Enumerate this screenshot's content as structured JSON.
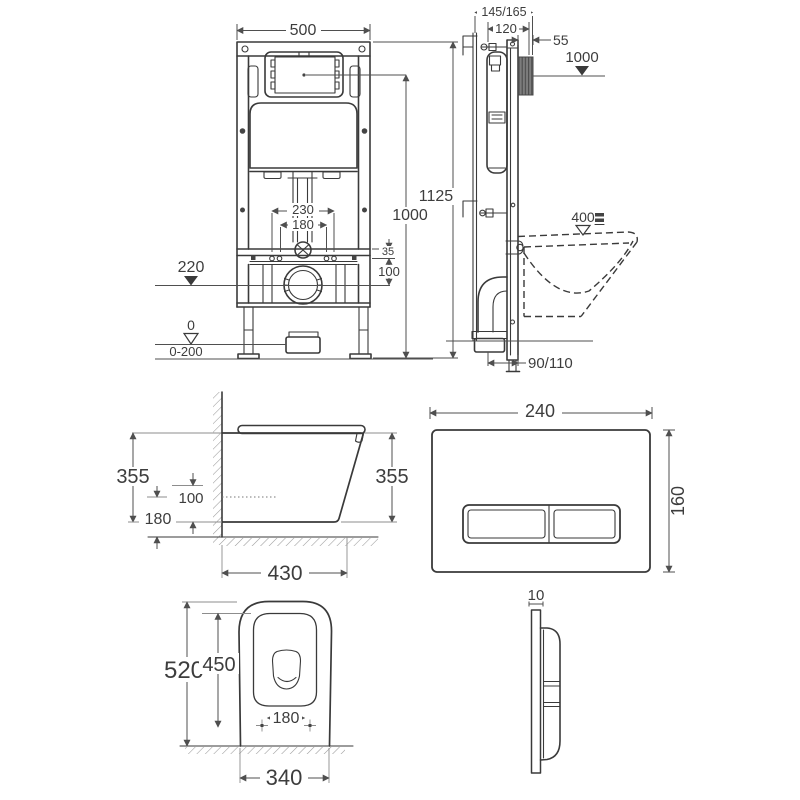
{
  "colors": {
    "line": "#3a3a3a",
    "dim": "#4f4f4f",
    "light": "#8d8d8d",
    "text": "#3d3d3d",
    "background": "#ffffff"
  },
  "views": {
    "frame_front": {
      "dims": {
        "width": "500",
        "total_height": "1125",
        "panel_center_height": "1000",
        "fixing_outer": "230",
        "fixing_inner": "180",
        "rail_offset": "35",
        "outlet_drop": "100",
        "outlet_level": "220",
        "floor_zero": "0",
        "floor_adjust": "0-200"
      }
    },
    "frame_side": {
      "dims": {
        "depth_total": "145/165",
        "frame_depth": "120",
        "plate_recess": "55",
        "plate_center_height": "1000",
        "rim_height": "400",
        "outlet_distance": "90/110"
      }
    },
    "pan_side": {
      "dims": {
        "height_left": "355",
        "height_right": "355",
        "supply_offset": "100",
        "outlet_height": "180",
        "projection": "430"
      }
    },
    "plate_front": {
      "dims": {
        "width": "240",
        "height": "160"
      }
    },
    "pan_top": {
      "dims": {
        "length": "520",
        "inner_length": "450",
        "fixing_spacing": "180",
        "width": "340"
      }
    },
    "plate_side": {
      "dims": {
        "thickness": "10"
      }
    }
  }
}
